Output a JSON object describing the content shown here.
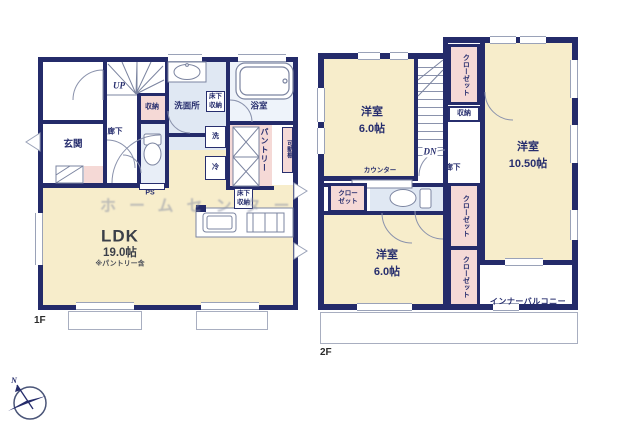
{
  "floor1": {
    "floor_label": "1F",
    "stairs_label": "UP",
    "entrance": "玄関",
    "hallway": "廊下",
    "storage": "収納",
    "washroom": "洗面所",
    "underfloor_storage_a": "床下収納",
    "underfloor_storage_b": "床下収納",
    "bathroom": "浴室",
    "washer": "洗",
    "fridge": "冷",
    "pantry": "パントリー",
    "movable_shelf": "可動棚",
    "pipe_space": "PS",
    "ldk_name": "LDK",
    "ldk_size": "19.0帖",
    "ldk_note": "※パントリー含"
  },
  "floor2": {
    "floor_label": "2F",
    "stairs_label": "DN",
    "closet_top": "クローゼット",
    "closet_left": "クローゼット",
    "closet_middle": "クローゼット",
    "closet_bottom": "クローゼット",
    "storage": "収納",
    "bedroom_a_name": "洋室",
    "bedroom_a_size": "6.0帖",
    "bedroom_b_name": "洋室",
    "bedroom_b_size": "10.50帖",
    "bedroom_c_name": "洋室",
    "bedroom_c_size": "6.0帖",
    "counter": "カウンター",
    "hallway": "廊下",
    "inner_balcony": "インナーバルコニー"
  },
  "overlay": {
    "watermark": "ホームセンター",
    "compass_north": "N"
  },
  "colors": {
    "wall_navy": "#242b6a",
    "room_cream": "#f7edcb",
    "closet_pink": "#f5d9d6",
    "wet_blue": "#e0e8f3",
    "bath_blue": "#eef3fa"
  }
}
